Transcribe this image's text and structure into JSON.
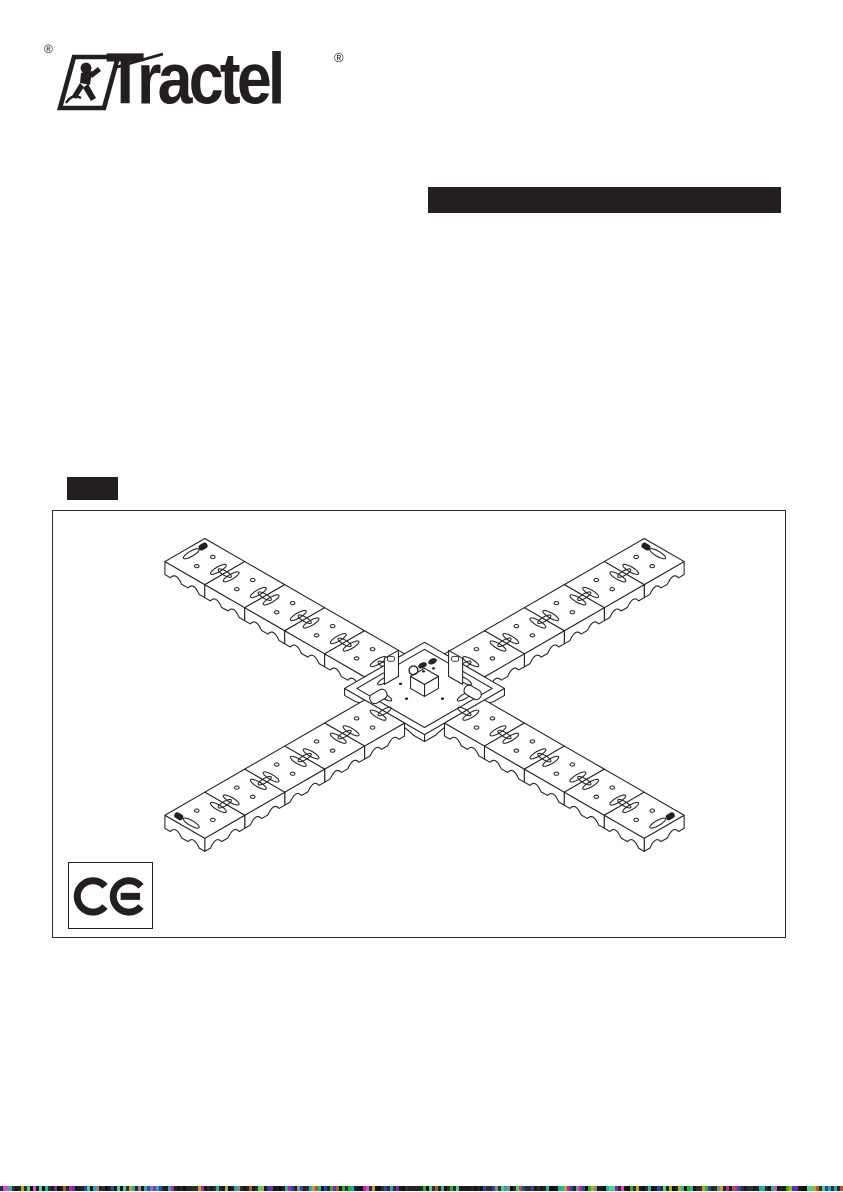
{
  "page": {
    "background": "#ffffff",
    "ink": "#231f20"
  },
  "logo": {
    "brand": "Tractel",
    "registered_mark": "®"
  },
  "header": {
    "title_bar_color": "#242021"
  },
  "language_badge": {
    "color": "#242021"
  },
  "figure": {
    "description": "Isometric line drawing of an X-shaped modular dead-weight anchor: four arms of five interlocking ballast plates around a 2x2 central base plate fitted with a swivel anchor point",
    "arms": 4,
    "plates_per_arm": 5,
    "frame_border_color": "#2b2828",
    "ce_mark": "CE"
  },
  "scan_strip": {
    "base_colors": [
      "#1a1a1a",
      "#242424",
      "#101010",
      "#2e2e2e"
    ],
    "accent_colors": [
      "#b327a8",
      "#27b394",
      "#b3a827",
      "#2748b3",
      "#7a27b3",
      "#27b327",
      "#b35727",
      "#27a7b3",
      "#8a8a8a",
      "#d04fd0",
      "#4fd08a"
    ]
  }
}
